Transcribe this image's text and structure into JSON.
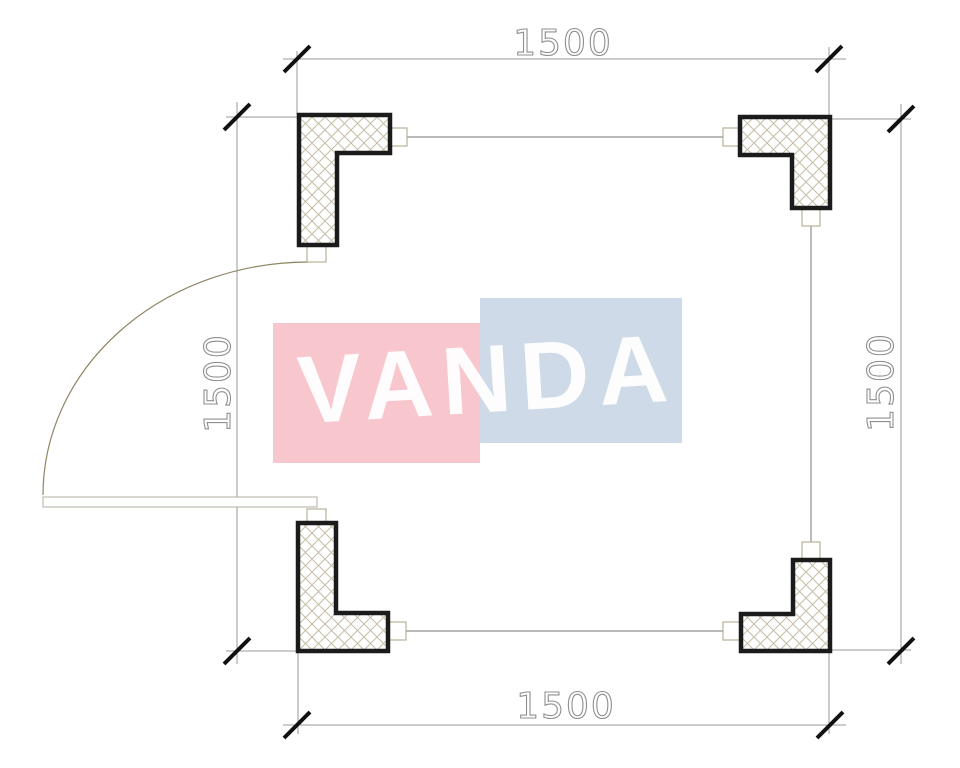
{
  "watermark": {
    "text": "VANDA",
    "pink_block_color": "#f8c7ce",
    "blue_block_color": "#cfdae8",
    "text_color": "#ffffff"
  },
  "dimensions": {
    "top": {
      "label": "1500"
    },
    "bottom": {
      "label": "1500"
    },
    "left": {
      "label": "1500"
    },
    "right": {
      "label": "1500"
    }
  },
  "colors": {
    "column_outline": "#1b1b1b",
    "hatch": "#c6bda6",
    "dimension_line": "#9a9a9a",
    "dimension_text_outline": "#8f8f8f",
    "tick": "#111111",
    "wall_line": "#8f8f8f",
    "door_arc": "#8f8565",
    "fixture_outline": "#b8b09a",
    "background": "#ffffff"
  }
}
